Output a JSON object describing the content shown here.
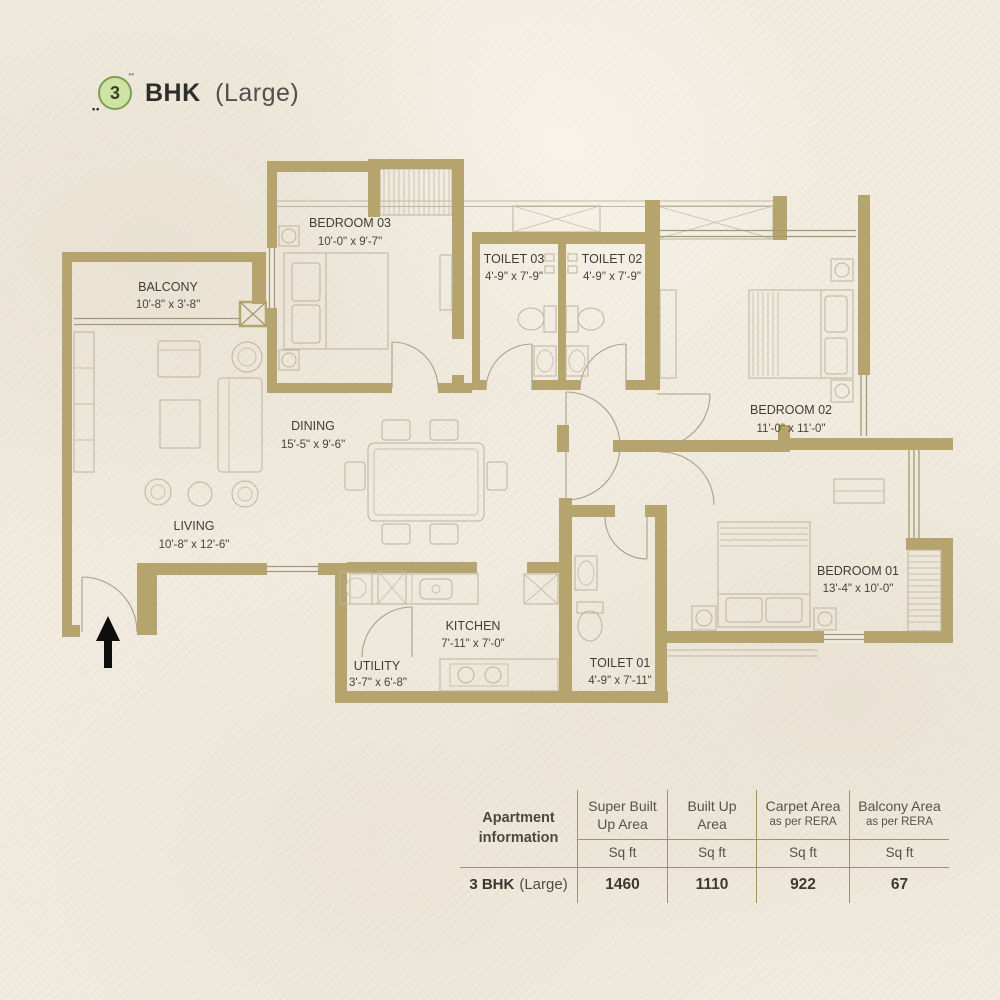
{
  "title": {
    "number": "3",
    "name": "BHK",
    "variant": "(Large)"
  },
  "colors": {
    "paper": "#f1ebdf",
    "wall": "#b5a46e",
    "badge_fill": "#cfe4a4",
    "badge_border": "#7f9d53",
    "table_line": "#a1935f",
    "text": "#3f3d36"
  },
  "plan": {
    "rooms": [
      {
        "id": "bedroom03",
        "name": "BEDROOM 03",
        "dims": "10'-0\" x 9'-7\""
      },
      {
        "id": "balcony",
        "name": "BALCONY",
        "dims": "10'-8\" x 3'-8\""
      },
      {
        "id": "toilet03",
        "name": "TOILET 03",
        "dims": "4'-9\" x 7'-9\""
      },
      {
        "id": "toilet02",
        "name": "TOILET 02",
        "dims": "4'-9\" x 7'-9\""
      },
      {
        "id": "bedroom02",
        "name": "BEDROOM 02",
        "dims": "11'-0\" x 11'-0\""
      },
      {
        "id": "dining",
        "name": "DINING",
        "dims": "15'-5\" x 9'-6\""
      },
      {
        "id": "living",
        "name": "LIVING",
        "dims": "10'-8\" x 12'-6\""
      },
      {
        "id": "kitchen",
        "name": "KITCHEN",
        "dims": "7'-11\" x 7'-0\""
      },
      {
        "id": "utility",
        "name": "UTILITY",
        "dims": "3'-7\" x 6'-8\""
      },
      {
        "id": "toilet01",
        "name": "TOILET 01",
        "dims": "4'-9\" x 7'-11\""
      },
      {
        "id": "bedroom01",
        "name": "BEDROOM 01",
        "dims": "13'-4\" x 10'-0\""
      }
    ]
  },
  "table": {
    "header_title_line1": "Apartment",
    "header_title_line2": "information",
    "columns": [
      {
        "title_line1": "Super Built",
        "title_line2": "Up Area",
        "unit": "Sq ft"
      },
      {
        "title_line1": "Built Up",
        "title_line2": "Area",
        "unit": "Sq ft"
      },
      {
        "title_line1": "Carpet Area",
        "title_line2": "as per RERA",
        "unit": "Sq ft"
      },
      {
        "title_line1": "Balcony Area",
        "title_line2": "as per RERA",
        "unit": "Sq ft"
      }
    ],
    "row": {
      "label_bold": "3 BHK",
      "label_light": "(Large)",
      "values": [
        "1460",
        "1110",
        "922",
        "67"
      ]
    }
  }
}
